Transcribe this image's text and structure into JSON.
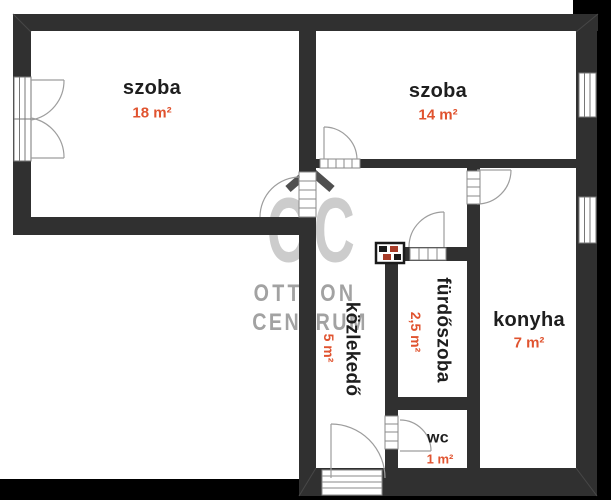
{
  "floorplan": {
    "rooms": [
      {
        "name": "szoba",
        "area": "18 m²",
        "orientation": "horizontal"
      },
      {
        "name": "szoba",
        "area": "14 m²",
        "orientation": "horizontal"
      },
      {
        "name": "közlekedő",
        "area": "5 m²",
        "orientation": "vertical"
      },
      {
        "name": "fürdőszoba",
        "area": "2,5 m²",
        "orientation": "vertical"
      },
      {
        "name": "konyha",
        "area": "7 m²",
        "orientation": "horizontal"
      },
      {
        "name": "wc",
        "area": "1 m²",
        "orientation": "horizontal"
      }
    ],
    "watermark": {
      "logo_text": "OC",
      "line1": "OTTHON",
      "line2": "CENTRUM"
    },
    "colors": {
      "wall": "#303030",
      "outside_band": "#000000",
      "background": "#ffffff",
      "room_label": "#1e1e1e",
      "area_label": "#e0532f",
      "watermark_light": "#c8c8c8",
      "watermark_mid": "#9e9e9e",
      "watermark_roof": "#4f4f4f",
      "door_line": "#9d9d9d",
      "chimney_accent": "#a83c28"
    }
  }
}
